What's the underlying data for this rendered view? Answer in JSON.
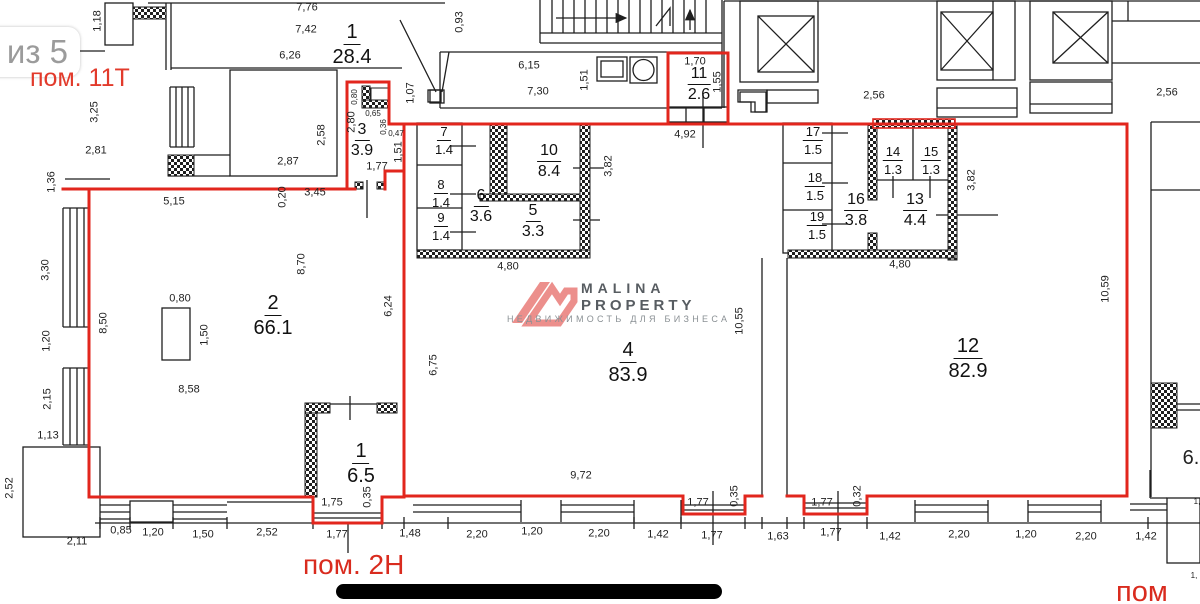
{
  "page": {
    "pager": "из 5",
    "premise_top": "пом. 11Т",
    "premise_bottom": "пом. 2Н",
    "premise_bottom_right": "пом"
  },
  "watermark": {
    "line1": "MALINA",
    "line2": "PROPERTY",
    "tagline": "НЕДВИЖИМОСТЬ ДЛЯ БИЗНЕСА",
    "logo_color": "#ec8f8c",
    "text_color": "#575c61"
  },
  "colors": {
    "outline_red": "#e2261d",
    "wall_black": "#1f1f1f",
    "label_red": "#d92b1e",
    "pager_gray": "#9b9b9b"
  },
  "plan": {
    "rooms": [
      {
        "num": "1",
        "area": "28.4",
        "x": 352,
        "y": 22,
        "size": "l"
      },
      {
        "num": "3",
        "area": "3.9",
        "x": 362,
        "y": 122,
        "size": "m"
      },
      {
        "num": "11",
        "area": "2.6",
        "x": 699,
        "y": 66,
        "size": "m"
      },
      {
        "num": "7",
        "area": "1.4",
        "x": 444,
        "y": 125,
        "size": "s"
      },
      {
        "num": "10",
        "area": "8.4",
        "x": 549,
        "y": 143,
        "size": "m"
      },
      {
        "num": "8",
        "area": "1.4",
        "x": 441,
        "y": 178,
        "size": "s"
      },
      {
        "num": "6",
        "area": "3.6",
        "x": 481,
        "y": 188,
        "size": "m"
      },
      {
        "num": "9",
        "area": "1.4",
        "x": 441,
        "y": 211,
        "size": "s"
      },
      {
        "num": "5",
        "area": "3.3",
        "x": 533,
        "y": 203,
        "size": "m"
      },
      {
        "num": "17",
        "area": "1.5",
        "x": 813,
        "y": 125,
        "size": "s"
      },
      {
        "num": "14",
        "area": "1.3",
        "x": 893,
        "y": 145,
        "size": "s"
      },
      {
        "num": "15",
        "area": "1.3",
        "x": 931,
        "y": 145,
        "size": "s"
      },
      {
        "num": "18",
        "area": "1.5",
        "x": 815,
        "y": 171,
        "size": "s"
      },
      {
        "num": "16",
        "area": "3.8",
        "x": 856,
        "y": 192,
        "size": "m"
      },
      {
        "num": "13",
        "area": "4.4",
        "x": 915,
        "y": 192,
        "size": "m"
      },
      {
        "num": "19",
        "area": "1.5",
        "x": 817,
        "y": 210,
        "size": "s"
      },
      {
        "num": "2",
        "area": "66.1",
        "x": 273,
        "y": 293,
        "size": "l"
      },
      {
        "num": "4",
        "area": "83.9",
        "x": 628,
        "y": 340,
        "size": "l"
      },
      {
        "num": "12",
        "area": "82.9",
        "x": 968,
        "y": 336,
        "size": "l"
      },
      {
        "num": "1",
        "area": "6.5",
        "x": 361,
        "y": 441,
        "size": "l"
      }
    ],
    "dims": [
      {
        "t": "7,76",
        "x": 307,
        "y": 8
      },
      {
        "t": "1,18",
        "x": 98,
        "y": 21,
        "v": 1
      },
      {
        "t": "7,42",
        "x": 306,
        "y": 30
      },
      {
        "t": "0,93",
        "x": 460,
        "y": 22,
        "v": 1
      },
      {
        "t": "6,26",
        "x": 290,
        "y": 56
      },
      {
        "t": "6,15",
        "x": 529,
        "y": 66
      },
      {
        "t": "1,51",
        "x": 585,
        "y": 80,
        "v": 1
      },
      {
        "t": "7,30",
        "x": 538,
        "y": 92
      },
      {
        "t": "1,70",
        "x": 695,
        "y": 62
      },
      {
        "t": "1,55",
        "x": 718,
        "y": 82,
        "v": 1
      },
      {
        "t": "4,92",
        "x": 685,
        "y": 135
      },
      {
        "t": "2,56",
        "x": 874,
        "y": 96
      },
      {
        "t": "2,56",
        "x": 1167,
        "y": 93
      },
      {
        "t": "3,25",
        "x": 95,
        "y": 112,
        "v": 1
      },
      {
        "t": "2,58",
        "x": 322,
        "y": 135,
        "v": 1
      },
      {
        "t": "2,81",
        "x": 96,
        "y": 151
      },
      {
        "t": "2,87",
        "x": 288,
        "y": 162
      },
      {
        "t": "1,07",
        "x": 411,
        "y": 93,
        "v": 1
      },
      {
        "t": "0,80",
        "x": 355,
        "y": 97,
        "v": 1,
        "small": 1
      },
      {
        "t": "2,80",
        "x": 352,
        "y": 122,
        "v": 1
      },
      {
        "t": "0,65",
        "x": 373,
        "y": 114,
        "small": 1
      },
      {
        "t": "0,36",
        "x": 384,
        "y": 127,
        "v": 1,
        "small": 1
      },
      {
        "t": "0,47",
        "x": 396,
        "y": 134,
        "small": 1
      },
      {
        "t": "1,51",
        "x": 399,
        "y": 152,
        "v": 1
      },
      {
        "t": "1,77",
        "x": 377,
        "y": 167
      },
      {
        "t": "1,36",
        "x": 52,
        "y": 182,
        "v": 1
      },
      {
        "t": "5,15",
        "x": 174,
        "y": 202
      },
      {
        "t": "0,20",
        "x": 283,
        "y": 197,
        "v": 1
      },
      {
        "t": "3,45",
        "x": 315,
        "y": 193
      },
      {
        "t": "3,30",
        "x": 46,
        "y": 270,
        "v": 1
      },
      {
        "t": "8,50",
        "x": 104,
        "y": 323,
        "v": 1
      },
      {
        "t": "8,70",
        "x": 302,
        "y": 264,
        "v": 1
      },
      {
        "t": "6,24",
        "x": 389,
        "y": 306,
        "v": 1
      },
      {
        "t": "0,80",
        "x": 180,
        "y": 299
      },
      {
        "t": "1,50",
        "x": 205,
        "y": 335,
        "v": 1
      },
      {
        "t": "8,58",
        "x": 189,
        "y": 390
      },
      {
        "t": "1,20",
        "x": 47,
        "y": 341,
        "v": 1
      },
      {
        "t": "2,15",
        "x": 48,
        "y": 399,
        "v": 1
      },
      {
        "t": "1,13",
        "x": 48,
        "y": 436
      },
      {
        "t": "2,52",
        "x": 10,
        "y": 488,
        "v": 1
      },
      {
        "t": "2,11",
        "x": 77,
        "y": 542
      },
      {
        "t": "6,75",
        "x": 434,
        "y": 365,
        "v": 1
      },
      {
        "t": "10,55",
        "x": 740,
        "y": 321,
        "v": 1
      },
      {
        "t": "10,59",
        "x": 1106,
        "y": 289,
        "v": 1
      },
      {
        "t": "3,82",
        "x": 609,
        "y": 166,
        "v": 1
      },
      {
        "t": "3,82",
        "x": 972,
        "y": 180,
        "v": 1
      },
      {
        "t": "4,80",
        "x": 508,
        "y": 267
      },
      {
        "t": "4,80",
        "x": 900,
        "y": 265
      },
      {
        "t": "9,72",
        "x": 581,
        "y": 476
      },
      {
        "t": "1,75",
        "x": 332,
        "y": 503
      },
      {
        "t": "0,35",
        "x": 368,
        "y": 497,
        "v": 1
      },
      {
        "t": "0,85",
        "x": 121,
        "y": 531
      },
      {
        "t": "1,20",
        "x": 153,
        "y": 533
      },
      {
        "t": "1,50",
        "x": 203,
        "y": 535
      },
      {
        "t": "2,52",
        "x": 267,
        "y": 533
      },
      {
        "t": "1,77",
        "x": 337,
        "y": 535
      },
      {
        "t": "1,48",
        "x": 410,
        "y": 534
      },
      {
        "t": "2,20",
        "x": 477,
        "y": 535
      },
      {
        "t": "1,20",
        "x": 532,
        "y": 532
      },
      {
        "t": "2,20",
        "x": 599,
        "y": 534
      },
      {
        "t": "1,42",
        "x": 658,
        "y": 535
      },
      {
        "t": "1,77",
        "x": 698,
        "y": 503
      },
      {
        "t": "0,35",
        "x": 735,
        "y": 496,
        "v": 1
      },
      {
        "t": "1,77",
        "x": 712,
        "y": 536
      },
      {
        "t": "1,63",
        "x": 778,
        "y": 537
      },
      {
        "t": "1,77",
        "x": 822,
        "y": 503
      },
      {
        "t": "0,32",
        "x": 858,
        "y": 496,
        "v": 1
      },
      {
        "t": "1,77",
        "x": 831,
        "y": 533
      },
      {
        "t": "1,42",
        "x": 890,
        "y": 537
      },
      {
        "t": "2,20",
        "x": 959,
        "y": 535
      },
      {
        "t": "1,20",
        "x": 1026,
        "y": 535
      },
      {
        "t": "2,20",
        "x": 1086,
        "y": 537
      },
      {
        "t": "1,42",
        "x": 1146,
        "y": 537
      },
      {
        "t": "6.",
        "x": 1191,
        "y": 458,
        "big": 1
      },
      {
        "t": "1,",
        "x": 1197,
        "y": 502,
        "small": 1
      },
      {
        "t": "1,",
        "x": 1194,
        "y": 576,
        "small": 1
      }
    ]
  }
}
